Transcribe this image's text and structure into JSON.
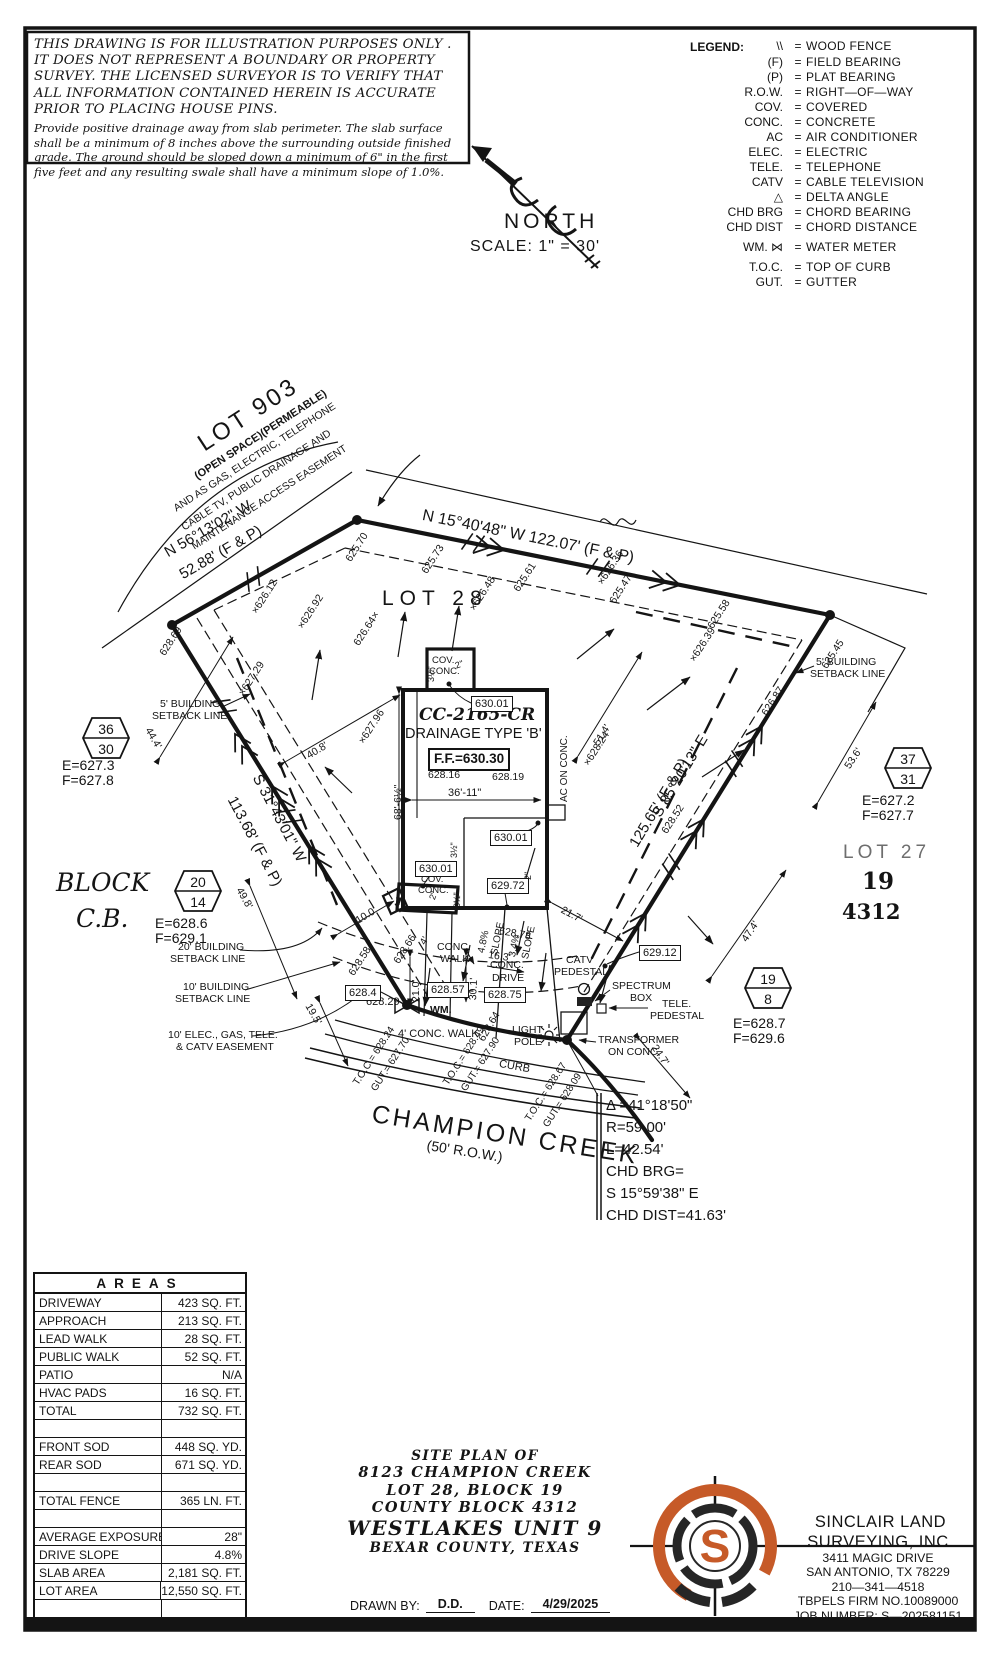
{
  "colors": {
    "accent": "#c65a28",
    "ink": "#141414"
  },
  "disclaimer": {
    "heading": "THIS DRAWING IS FOR ILLUSTRATION PURPOSES ONLY . IT DOES NOT REPRESENT A BOUNDARY OR PROPERTY SURVEY. THE LICENSED SURVEYOR IS TO VERIFY THAT ALL INFORMATION CONTAINED HEREIN IS ACCURATE PRIOR TO PLACING HOUSE PINS.",
    "body": "Provide positive drainage away from slab perimeter. The slab surface shall be a minimum of 8 inches above the surrounding outside finished grade. The ground should be sloped down a minimum of 6\" in the first five feet and any resulting swale shall have a minimum slope of 1.0%."
  },
  "legend": {
    "title": "LEGEND:",
    "items": [
      {
        "s": "\\\\",
        "eq": "=",
        "l": "WOOD FENCE",
        "y": 40
      },
      {
        "s": "(F)",
        "eq": "=",
        "l": "FIELD BEARING",
        "y": 56
      },
      {
        "s": "(P)",
        "eq": "=",
        "l": "PLAT BEARING",
        "y": 71
      },
      {
        "s": "R.O.W.",
        "eq": "=",
        "l": "RIGHT—OF—WAY",
        "y": 86
      },
      {
        "s": "COV.",
        "eq": "=",
        "l": "COVERED",
        "y": 101
      },
      {
        "s": "CONC.",
        "eq": "=",
        "l": "CONCRETE",
        "y": 116
      },
      {
        "s": "AC",
        "eq": "=",
        "l": "AIR CONDITIONER",
        "y": 131
      },
      {
        "s": "ELEC.",
        "eq": "=",
        "l": "ELECTRIC",
        "y": 146
      },
      {
        "s": "TELE.",
        "eq": "=",
        "l": "TELEPHONE",
        "y": 161
      },
      {
        "s": "CATV",
        "eq": "=",
        "l": "CABLE TELEVISION",
        "y": 176
      },
      {
        "s": "△",
        "eq": "=",
        "l": "DELTA ANGLE",
        "y": 191
      },
      {
        "s": "CHD BRG",
        "eq": "=",
        "l": "CHORD BEARING",
        "y": 206
      },
      {
        "s": "CHD DIST",
        "eq": "=",
        "l": "CHORD DISTANCE",
        "y": 221
      },
      {
        "s": "WM. ⋈",
        "eq": "=",
        "l": "WATER METER",
        "y": 241
      },
      {
        "s": "T.O.C.",
        "eq": "=",
        "l": "TOP OF CURB",
        "y": 261
      },
      {
        "s": "GUT.",
        "eq": "=",
        "l": "GUTTER",
        "y": 276
      }
    ]
  },
  "compass": {
    "north": "NORTH",
    "scale": "SCALE:  1\" = 30'"
  },
  "plan": {
    "texts": [
      {
        "t": "LOT 903",
        "x": 194,
        "y": 436,
        "r": -33,
        "s": 24,
        "c": "ls3"
      },
      {
        "t": "(OPEN SPACE)(PERMEABLE)",
        "x": 193,
        "y": 473,
        "r": -33,
        "s": 11,
        "c": "b"
      },
      {
        "t": "AND AS GAS, ELECTRIC, TELEPHONE",
        "x": 172,
        "y": 505,
        "r": -33,
        "s": 10.5
      },
      {
        "t": "CABLE TV, PUBLIC DRAINAGE AND",
        "x": 180,
        "y": 524,
        "r": -33,
        "s": 10.5
      },
      {
        "t": "MAINTENANCE ACCESS EASEMENT",
        "x": 190,
        "y": 543,
        "r": -33,
        "s": 10.5
      },
      {
        "t": "N 56°13'02\" W",
        "x": 162,
        "y": 547,
        "r": -30,
        "s": 15
      },
      {
        "t": "52.88' (F & P)",
        "x": 177,
        "y": 569,
        "r": -30,
        "s": 15
      },
      {
        "t": "N 15°40'48\" W 122.07' (F & P)",
        "x": 424,
        "y": 508,
        "r": 11.5,
        "s": 16
      },
      {
        "t": "LOT 28",
        "x": 382,
        "y": 588,
        "s": 21,
        "c": "ls5"
      },
      {
        "t": "S 31°43'01\" W",
        "x": 263,
        "y": 772,
        "r": 62,
        "s": 15
      },
      {
        "t": "113.68' (F & P)",
        "x": 238,
        "y": 794,
        "r": 62,
        "s": 15
      },
      {
        "t": "S 85°20'13\" E",
        "x": 650,
        "y": 812,
        "r": -59,
        "s": 15
      },
      {
        "t": "125.65' (F & P)",
        "x": 627,
        "y": 842,
        "r": -59,
        "s": 15
      },
      {
        "t": "LOT 27",
        "x": 843,
        "y": 843,
        "s": 19,
        "c": "ls4 gray"
      },
      {
        "t": "19",
        "x": 862,
        "y": 870,
        "s": 23,
        "c": "serifb"
      },
      {
        "t": "4312",
        "x": 842,
        "y": 901,
        "s": 21,
        "c": "serifb"
      },
      {
        "t": "BLOCK",
        "x": 56,
        "y": 870,
        "s": 25,
        "c": "serifi"
      },
      {
        "t": "C.B.",
        "x": 76,
        "y": 906,
        "s": 25,
        "c": "serifi"
      },
      {
        "t": "CHAMPION CREEK",
        "x": 374,
        "y": 1102,
        "r": 9,
        "s": 25,
        "c": "ls3"
      },
      {
        "t": "(50' R.O.W.)",
        "x": 428,
        "y": 1138,
        "r": 9,
        "s": 14
      },
      {
        "t": "Δ =41°18'50\"",
        "x": 606,
        "y": 1098,
        "s": 15
      },
      {
        "t": "R=59.00'",
        "x": 606,
        "y": 1120,
        "s": 15
      },
      {
        "t": "L=42.54'",
        "x": 606,
        "y": 1142,
        "s": 15
      },
      {
        "t": "CHD BRG=",
        "x": 606,
        "y": 1164,
        "s": 15
      },
      {
        "t": "S 15°59'38\" E",
        "x": 606,
        "y": 1186,
        "s": 15
      },
      {
        "t": "CHD DIST=41.63'",
        "x": 606,
        "y": 1208,
        "s": 15
      },
      {
        "t": "5' BUILDING",
        "x": 160,
        "y": 699,
        "s": 10.5
      },
      {
        "t": "SETBACK LINE",
        "x": 152,
        "y": 711,
        "s": 10.5
      },
      {
        "t": "5' BUILDING",
        "x": 816,
        "y": 657,
        "s": 10.5
      },
      {
        "t": "SETBACK LINE",
        "x": 810,
        "y": 669,
        "s": 10.5
      },
      {
        "t": "20' BUILDING",
        "x": 178,
        "y": 942,
        "s": 10.5
      },
      {
        "t": "SETBACK LINE",
        "x": 170,
        "y": 954,
        "s": 10.5
      },
      {
        "t": "10' BUILDING",
        "x": 183,
        "y": 982,
        "s": 10.5
      },
      {
        "t": "SETBACK LINE",
        "x": 175,
        "y": 994,
        "s": 10.5
      },
      {
        "t": "10' ELEC., GAS, TELE.",
        "x": 168,
        "y": 1030,
        "s": 10.5
      },
      {
        "t": "& CATV EASEMENT",
        "x": 176,
        "y": 1042,
        "s": 10.5
      },
      {
        "t": "COV.",
        "x": 432,
        "y": 656,
        "s": 9.5
      },
      {
        "t": "CONC.",
        "x": 429,
        "y": 667,
        "s": 9.5
      },
      {
        "t": "2\"",
        "x": 454,
        "y": 662,
        "r": -20,
        "s": 9
      },
      {
        "t": "3½\"",
        "x": 427,
        "y": 682,
        "r": -90,
        "s": 9
      },
      {
        "t": "CC-2165-CR",
        "x": 419,
        "y": 707,
        "s": 17,
        "c": "serifbi"
      },
      {
        "t": "DRAINAGE TYPE 'B'",
        "x": 405,
        "y": 727,
        "s": 14.5
      },
      {
        "t": "628.16",
        "x": 428,
        "y": 770,
        "s": 10.5
      },
      {
        "t": "628.19",
        "x": 492,
        "y": 772,
        "s": 10.5
      },
      {
        "t": "36'-11\"",
        "x": 448,
        "y": 788,
        "s": 11
      },
      {
        "t": "68'-6½\"",
        "x": 393,
        "y": 820,
        "r": -90,
        "s": 10.5
      },
      {
        "t": "AC ON CONC.",
        "x": 560,
        "y": 802,
        "r": -90,
        "s": 10
      },
      {
        "t": "COV.",
        "x": 421,
        "y": 875,
        "s": 9.5
      },
      {
        "t": "CONC.",
        "x": 418,
        "y": 886,
        "s": 9.5
      },
      {
        "t": "3½\"",
        "x": 450,
        "y": 858,
        "r": -90,
        "s": 9
      },
      {
        "t": "3½\"",
        "x": 453,
        "y": 908,
        "r": -90,
        "s": 9
      },
      {
        "t": "2\"",
        "x": 524,
        "y": 880,
        "r": -90,
        "s": 9
      },
      {
        "t": "2\"",
        "x": 428,
        "y": 898,
        "r": -70,
        "s": 9
      },
      {
        "t": "CONC.",
        "x": 437,
        "y": 942,
        "s": 10.5
      },
      {
        "t": "WALK",
        "x": 440,
        "y": 954,
        "s": 10.5
      },
      {
        "t": "CONC.",
        "x": 490,
        "y": 960,
        "s": 10.5
      },
      {
        "t": "DRIVE",
        "x": 492,
        "y": 973,
        "s": 10.5
      },
      {
        "t": "4' CONC. WALK",
        "x": 398,
        "y": 1029,
        "s": 11
      },
      {
        "t": "WM.",
        "x": 430,
        "y": 1005,
        "s": 10.5,
        "c": "b"
      },
      {
        "t": "LIGHT",
        "x": 512,
        "y": 1025,
        "s": 10.5
      },
      {
        "t": "POLE",
        "x": 514,
        "y": 1037,
        "s": 10.5
      },
      {
        "t": "CURB",
        "x": 500,
        "y": 1059,
        "r": 10,
        "s": 11
      },
      {
        "t": "CATV",
        "x": 566,
        "y": 955,
        "s": 10.5
      },
      {
        "t": "PEDESTAL",
        "x": 554,
        "y": 967,
        "s": 10.5
      },
      {
        "t": "SPECTRUM",
        "x": 612,
        "y": 981,
        "s": 10.5
      },
      {
        "t": "BOX",
        "x": 630,
        "y": 993,
        "s": 10.5
      },
      {
        "t": "TELE.",
        "x": 662,
        "y": 999,
        "s": 10.5
      },
      {
        "t": "PEDESTAL",
        "x": 650,
        "y": 1011,
        "s": 10.5
      },
      {
        "t": "TRANSFORMER",
        "x": 598,
        "y": 1035,
        "s": 10.5
      },
      {
        "t": "ON CONC.",
        "x": 608,
        "y": 1047,
        "s": 10.5
      },
      {
        "t": "T.O.C.= 628.24",
        "x": 352,
        "y": 1082,
        "r": -57,
        "s": 10
      },
      {
        "t": "GUT.= 627.70",
        "x": 370,
        "y": 1088,
        "r": -57,
        "s": 10
      },
      {
        "t": "T.O.C.= 628.49",
        "x": 442,
        "y": 1082,
        "r": -57,
        "s": 10
      },
      {
        "t": "GUT.= 627.90",
        "x": 460,
        "y": 1088,
        "r": -57,
        "s": 10
      },
      {
        "t": "T.O.C.= 628.67",
        "x": 524,
        "y": 1118,
        "r": -57,
        "s": 10
      },
      {
        "t": "GUT.= 628.09",
        "x": 542,
        "y": 1124,
        "r": -57,
        "s": 10
      },
      {
        "t": "44.4'",
        "x": 152,
        "y": 726,
        "r": 60,
        "s": 10.5
      },
      {
        "t": "40.8'",
        "x": 305,
        "y": 752,
        "r": -31,
        "s": 10.5
      },
      {
        "t": "49.8'",
        "x": 243,
        "y": 886,
        "r": 60,
        "s": 10.5
      },
      {
        "t": "19.5'",
        "x": 312,
        "y": 1002,
        "r": 60,
        "s": 10.5
      },
      {
        "t": "10.0'",
        "x": 354,
        "y": 917,
        "r": -31,
        "s": 10.5
      },
      {
        "t": "21.0'",
        "x": 411,
        "y": 1002,
        "r": -90,
        "s": 10.5
      },
      {
        "t": "30.1'",
        "x": 468,
        "y": 1000,
        "r": -87,
        "s": 10.5
      },
      {
        "t": "16.3'",
        "x": 489,
        "y": 950,
        "r": 8,
        "s": 10.5
      },
      {
        "t": "4.8%",
        "x": 477,
        "y": 952,
        "r": -78,
        "s": 10
      },
      {
        "t": "SLOPE",
        "x": 490,
        "y": 954,
        "r": -78,
        "s": 10
      },
      {
        "t": "3.4%",
        "x": 508,
        "y": 956,
        "r": -78,
        "s": 10
      },
      {
        "t": "SLOPE",
        "x": 521,
        "y": 958,
        "r": -78,
        "s": 10
      },
      {
        "t": "21.7'",
        "x": 564,
        "y": 905,
        "r": 28,
        "s": 10.5
      },
      {
        "t": "47.4'",
        "x": 740,
        "y": 938,
        "r": -56,
        "s": 10.5
      },
      {
        "t": "24.7'",
        "x": 658,
        "y": 1043,
        "r": 56,
        "s": 10.5
      },
      {
        "t": "53.6'",
        "x": 843,
        "y": 765,
        "r": -56,
        "s": 10.5
      },
      {
        "t": "51.4'",
        "x": 592,
        "y": 742,
        "r": -58,
        "s": 10.5
      },
      {
        "t": "625.70",
        "x": 344,
        "y": 558,
        "r": -57,
        "s": 10.5
      },
      {
        "t": "625.73",
        "x": 420,
        "y": 570,
        "r": -57,
        "s": 10.5
      },
      {
        "t": "625.61",
        "x": 512,
        "y": 588,
        "r": -57,
        "s": 10.5
      },
      {
        "t": "×626.48",
        "x": 468,
        "y": 607,
        "r": -57,
        "s": 10.5
      },
      {
        "t": "×626.36",
        "x": 596,
        "y": 581,
        "r": -57,
        "s": 10.5
      },
      {
        "t": "625.47",
        "x": 608,
        "y": 600,
        "r": -57,
        "s": 10.5
      },
      {
        "t": "×626.12",
        "x": 250,
        "y": 610,
        "r": -57,
        "s": 10.5
      },
      {
        "t": "×626.92",
        "x": 296,
        "y": 625,
        "r": -57,
        "s": 10.5
      },
      {
        "t": "626.64×",
        "x": 352,
        "y": 642,
        "r": -57,
        "s": 10.5
      },
      {
        "t": "628.69",
        "x": 158,
        "y": 652,
        "r": -57,
        "s": 10.5
      },
      {
        "t": "×627.29",
        "x": 237,
        "y": 692,
        "r": -57,
        "s": 10.5
      },
      {
        "t": "×627.96",
        "x": 357,
        "y": 740,
        "r": -57,
        "s": 10.5
      },
      {
        "t": "×626.39",
        "x": 688,
        "y": 658,
        "r": -57,
        "s": 10.5
      },
      {
        "t": "625.58",
        "x": 706,
        "y": 625,
        "r": -57,
        "s": 10.5
      },
      {
        "t": "625.45",
        "x": 820,
        "y": 665,
        "r": -57,
        "s": 10.5
      },
      {
        "t": "626.87",
        "x": 760,
        "y": 712,
        "r": -57,
        "s": 10.5
      },
      {
        "t": "×628.24",
        "x": 582,
        "y": 762,
        "r": -57,
        "s": 10.5
      },
      {
        "t": "628.52",
        "x": 660,
        "y": 830,
        "r": -57,
        "s": 10.5
      },
      {
        "t": "628.58",
        "x": 347,
        "y": 972,
        "r": -57,
        "s": 10.5
      },
      {
        "t": "628.66",
        "x": 392,
        "y": 960,
        "r": -57,
        "s": 10.5
      },
      {
        "t": "628.78",
        "x": 500,
        "y": 926,
        "r": 10,
        "s": 10.5
      },
      {
        "t": "628.64",
        "x": 477,
        "y": 1038,
        "r": -60,
        "s": 10.5
      },
      {
        "t": "628.29",
        "x": 366,
        "y": 997,
        "s": 11
      },
      {
        "t": "4'",
        "x": 419,
        "y": 942,
        "r": -60,
        "s": 10
      },
      {
        "t": "E=627.3",
        "x": 62,
        "y": 758,
        "s": 14
      },
      {
        "t": "F=627.8",
        "x": 62,
        "y": 773,
        "s": 14
      },
      {
        "t": "E=628.6",
        "x": 155,
        "y": 916,
        "s": 14
      },
      {
        "t": "F=629.1",
        "x": 155,
        "y": 931,
        "s": 14
      },
      {
        "t": "E=627.2",
        "x": 862,
        "y": 793,
        "s": 14
      },
      {
        "t": "F=627.7",
        "x": 862,
        "y": 808,
        "s": 14
      },
      {
        "t": "E=628.7",
        "x": 733,
        "y": 1016,
        "s": 14
      },
      {
        "t": "F=629.6",
        "x": 733,
        "y": 1031,
        "s": 14
      }
    ],
    "boxes": [
      {
        "t": "630.01",
        "x": 471,
        "y": 696
      },
      {
        "t": "630.01",
        "x": 490,
        "y": 830
      },
      {
        "t": "630.01",
        "x": 415,
        "y": 861
      },
      {
        "t": "629.72",
        "x": 487,
        "y": 878
      },
      {
        "t": "628.4",
        "x": 345,
        "y": 985
      },
      {
        "t": "628.57",
        "x": 427,
        "y": 982
      },
      {
        "t": "628.75",
        "x": 484,
        "y": 987
      },
      {
        "t": "629.12",
        "x": 639,
        "y": 945
      },
      {
        "t": "F.F.=630.30",
        "x": 428,
        "y": 748,
        "c": "ff"
      }
    ],
    "hexagons": [
      {
        "x": 82,
        "y": 716,
        "top": "36",
        "bottom": "30"
      },
      {
        "x": 174,
        "y": 869,
        "top": "20",
        "bottom": "14"
      },
      {
        "x": 884,
        "y": 746,
        "top": "37",
        "bottom": "31"
      },
      {
        "x": 744,
        "y": 966,
        "top": "19",
        "bottom": "8"
      }
    ]
  },
  "areas_table": {
    "title": "AREAS",
    "rows": [
      {
        "label": "DRIVEWAY",
        "value": "423 SQ. FT."
      },
      {
        "label": "APPROACH",
        "value": "213 SQ. FT."
      },
      {
        "label": "LEAD WALK",
        "value": "28 SQ. FT."
      },
      {
        "label": "PUBLIC WALK",
        "value": "52 SQ. FT."
      },
      {
        "label": "PATIO",
        "value": "N/A"
      },
      {
        "label": "HVAC PADS",
        "value": "16 SQ. FT."
      },
      {
        "label": "TOTAL",
        "value": "732 SQ. FT."
      },
      {
        "label": "",
        "value": ""
      },
      {
        "label": "FRONT SOD",
        "value": "448 SQ. YD."
      },
      {
        "label": "REAR SOD",
        "value": "671 SQ. YD."
      },
      {
        "label": "",
        "value": ""
      },
      {
        "label": "TOTAL FENCE",
        "value": "365 LN. FT."
      },
      {
        "label": "",
        "value": ""
      },
      {
        "label": "AVERAGE EXPOSURE",
        "value": "28\""
      },
      {
        "label": "DRIVE SLOPE",
        "value": "4.8%"
      },
      {
        "label": "SLAB AREA",
        "value": "2,181 SQ. FT."
      },
      {
        "label": "LOT AREA",
        "value": "12,550 SQ. FT."
      },
      {
        "label": "",
        "value": ""
      }
    ]
  },
  "title_block": {
    "lines": [
      {
        "t": "SITE PLAN OF",
        "s": 13.5
      },
      {
        "t": "8123 CHAMPION CREEK",
        "s": 14.5
      },
      {
        "t": "LOT 28, BLOCK 19",
        "s": 14.5
      },
      {
        "t": "COUNTY BLOCK 4312",
        "s": 14.5
      },
      {
        "t": "WESTLAKES UNIT 9",
        "s": 20
      },
      {
        "t": "BEXAR COUNTY, TEXAS",
        "s": 13.5
      }
    ]
  },
  "drawn_by": {
    "label": "DRAWN BY:",
    "value": "D.D.",
    "date_label": "DATE:",
    "date": "4/29/2025"
  },
  "surveyor": {
    "logo_letter": "S",
    "name1": "SINCLAIR LAND",
    "name2": "SURVEYING, INC.",
    "addr1": "3411 MAGIC DRIVE",
    "addr2": "SAN ANTONIO, TX 78229",
    "phone": "210—341—4518",
    "firm": "TBPELS FIRM NO.10089000",
    "job": "JOB NUMBER: S—202581151"
  }
}
